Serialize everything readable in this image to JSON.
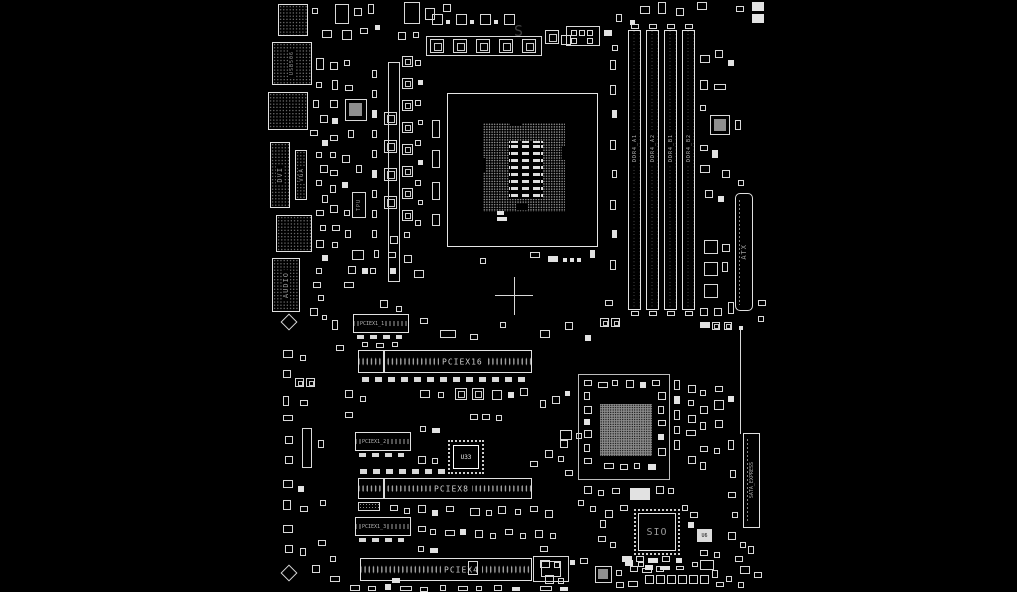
{
  "diagram": {
    "title": "motherboard-boardview",
    "background_color": "#000000",
    "line_color": "#e0e0e0",
    "label_color": "#9a9a9a",
    "labels": {
      "dvi": "DVI",
      "vga": "VGA",
      "audio": "AUDIO",
      "usb_port": "USB506",
      "tpu": "TPU",
      "atx": "ATX",
      "sata_express": "SATA_EXPRESS",
      "sio": "SIO",
      "u33": "U33",
      "u6": "U6",
      "watermark": "S"
    },
    "dimm_slots": [
      {
        "label": "DDR4_A1"
      },
      {
        "label": "DDR4_A2"
      },
      {
        "label": "DDR4_B1"
      },
      {
        "label": "DDR4_B2"
      }
    ],
    "pcie_slots": [
      {
        "label": "PCIEX16"
      },
      {
        "label": "PCIEX8"
      },
      {
        "label": "PCIEX4"
      }
    ],
    "pciex1_slots": [
      {
        "label": "PCIEX1_1"
      },
      {
        "label": "PCIEX1_2"
      },
      {
        "label": "PCIEX1_3"
      }
    ]
  }
}
